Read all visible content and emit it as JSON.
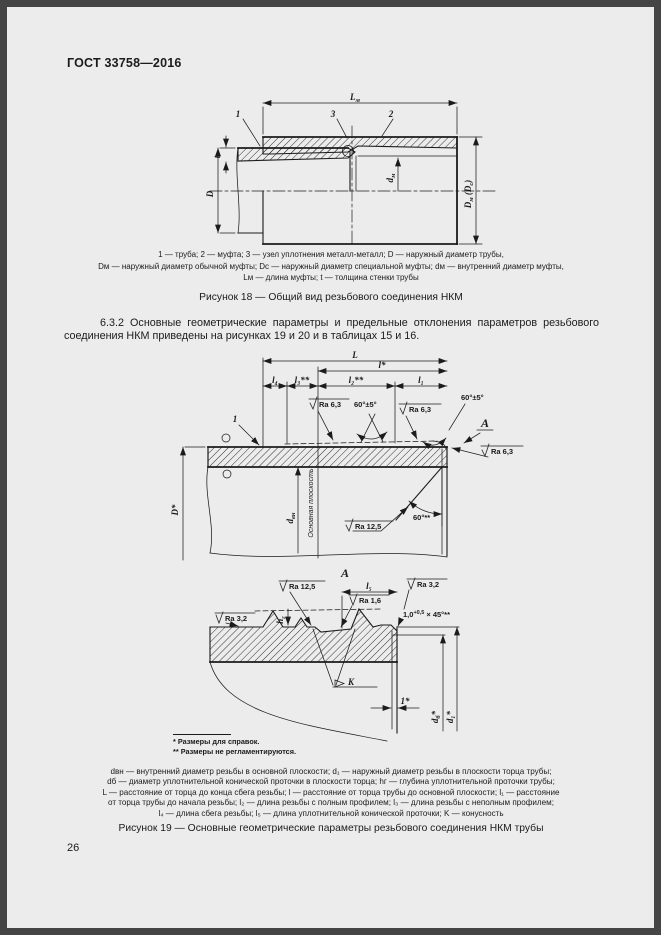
{
  "page": {
    "header": "ГОСТ 33758—2016",
    "number": "26"
  },
  "fig18": {
    "callout_1": "1",
    "callout_2": "2",
    "callout_3": "3",
    "dim_Lm": {
      "b": "L",
      "s": "м"
    },
    "dim_D": "D",
    "dim_t": "t",
    "dim_dm": {
      "b": "d",
      "s": "м"
    },
    "dim_Dm_Ds": {
      "b1": "D",
      "s1": "м",
      "b2": " (D",
      "s2": "с",
      "b3": ")"
    },
    "caption": [
      "1 — труба; 2 — муфта; 3 — узел уплотнения металл-металл; D — наружный диаметр трубы,",
      "Dм — наружный диаметр обычной муфты; Dс — наружный диаметр специальной муфты; dм — внутренний диаметр муфты,",
      "Lм — длина муфты; t — толщина стенки трубы"
    ],
    "title": "Рисунок 18 — Общий вид резьбового соединения НКМ"
  },
  "section_6_3_2": "6.3.2 Основные геометрические параметры и предельные отклонения параметров резьбового соединения НКМ приведены на рисунках 19 и 20 и в таблицах 15 и 16.",
  "fig19": {
    "upper": {
      "dim_L": "L",
      "dim_l": "l*",
      "dim_l4": "l₄",
      "dim_l3": "l₃**",
      "dim_l2": "l₂**",
      "dim_l1": "l₁",
      "callout_1": "1",
      "dim_D": "D*",
      "dim_dvn": {
        "b": "d",
        "s": "вн"
      },
      "basic_plane": "Основная плоскость",
      "ra_6_3": "Ra 6,3",
      "ra_12_5": "Ra 12,5",
      "angle_60_5": "60°±5°",
      "angle_60": "60°**",
      "view_a": "А"
    },
    "lower": {
      "view_title": "А",
      "dim_l5": "l₅",
      "ra_12_5": "Ra 12,5",
      "ra_1_6": "Ra 1,6",
      "ra_3_2": "Ra 3,2",
      "chamfer": {
        "b": "1,0",
        "sup": "+0,5",
        "e": " × 45°**"
      },
      "dim_hg": {
        "b": "h",
        "s": "г"
      },
      "conicity": "K",
      "dim_1": "1*",
      "dim_db": {
        "b": "d",
        "s": "б",
        "a": "*"
      },
      "dim_d1": "d₁*"
    },
    "footnote_1": "* Размеры для справок.",
    "footnote_2": "** Размеры не регламентируются.",
    "legend": [
      "dвн — внутренний диаметр резьбы в основной плоскости; d₁ — наружный диаметр резьбы в плоскости торца трубы;",
      "dб — диаметр уплотнительной конической проточки в плоскости торца; hг — глубина уплотнительной проточки трубы;",
      "L — расстояние от торца до конца сбега резьбы; l — расстояние от торца трубы до основной плоскости; l₁ — расстояние",
      "от торца трубы до начала резьбы; l₂ — длина резьбы с полным профилем; l₃ — длина резьбы с неполным профилем;",
      "l₄ — длина сбега резьбы; l₅ — длина уплотнительной конической проточки; K — конусность"
    ],
    "title": "Рисунок 19 — Основные геометрические параметры резьбового соединения НКМ трубы"
  }
}
